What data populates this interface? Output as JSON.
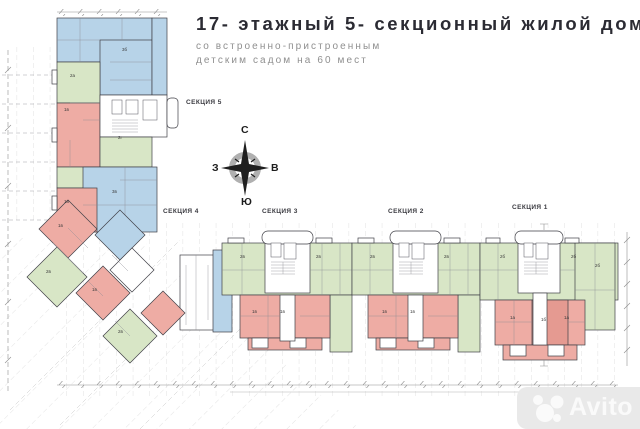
{
  "title": {
    "line1": "17- этажный 5- секционный жилой дом",
    "line2": "со встроенно-пристроенным",
    "line3": "детским садом на 60 мест"
  },
  "compass": {
    "north": "С",
    "south": "Ю",
    "west": "З",
    "east": "В"
  },
  "sections": [
    {
      "label": "СЕКЦИЯ 5"
    },
    {
      "label": "СЕКЦИЯ 4"
    },
    {
      "label": "СЕКЦИЯ 3"
    },
    {
      "label": "СЕКЦИЯ 2"
    },
    {
      "label": "СЕКЦИЯ 1"
    }
  ],
  "apartments": [
    {
      "label": "3б",
      "x": 122,
      "y": 48
    },
    {
      "label": "2а",
      "x": 70,
      "y": 74
    },
    {
      "label": "1в",
      "x": 64,
      "y": 108
    },
    {
      "label": "2г",
      "x": 118,
      "y": 136
    },
    {
      "label": "3в",
      "x": 112,
      "y": 190
    },
    {
      "label": "1в",
      "x": 64,
      "y": 200
    },
    {
      "label": "1в",
      "x": 58,
      "y": 224
    },
    {
      "label": "2в",
      "x": 46,
      "y": 270
    },
    {
      "label": "1в",
      "x": 92,
      "y": 288
    },
    {
      "label": "2в",
      "x": 118,
      "y": 330
    },
    {
      "label": "2в",
      "x": 240,
      "y": 255
    },
    {
      "label": "2в",
      "x": 316,
      "y": 255
    },
    {
      "label": "1в",
      "x": 252,
      "y": 310
    },
    {
      "label": "1в",
      "x": 280,
      "y": 310
    },
    {
      "label": "2в",
      "x": 370,
      "y": 255
    },
    {
      "label": "2в",
      "x": 444,
      "y": 255
    },
    {
      "label": "1в",
      "x": 382,
      "y": 310
    },
    {
      "label": "1в",
      "x": 410,
      "y": 310
    },
    {
      "label": "2б",
      "x": 500,
      "y": 255
    },
    {
      "label": "2б",
      "x": 571,
      "y": 255
    },
    {
      "label": "2б",
      "x": 595,
      "y": 264
    },
    {
      "label": "1а",
      "x": 510,
      "y": 316
    },
    {
      "label": "1б",
      "x": 541,
      "y": 318
    },
    {
      "label": "1а",
      "x": 564,
      "y": 316
    }
  ],
  "watermark": {
    "brand": "Avito"
  },
  "colors": {
    "apartment_blue": "#b7d3e8",
    "apartment_green": "#d8e6c6",
    "apartment_red": "#eeaca4",
    "apartment_red_dark": "#e59a91",
    "walls": "#3f3f46",
    "grid": "#c5c5c5",
    "title_text": "#2b2b33",
    "subtitle_text": "#8f8f8f",
    "watermark_bg": "#e9e9e9"
  }
}
